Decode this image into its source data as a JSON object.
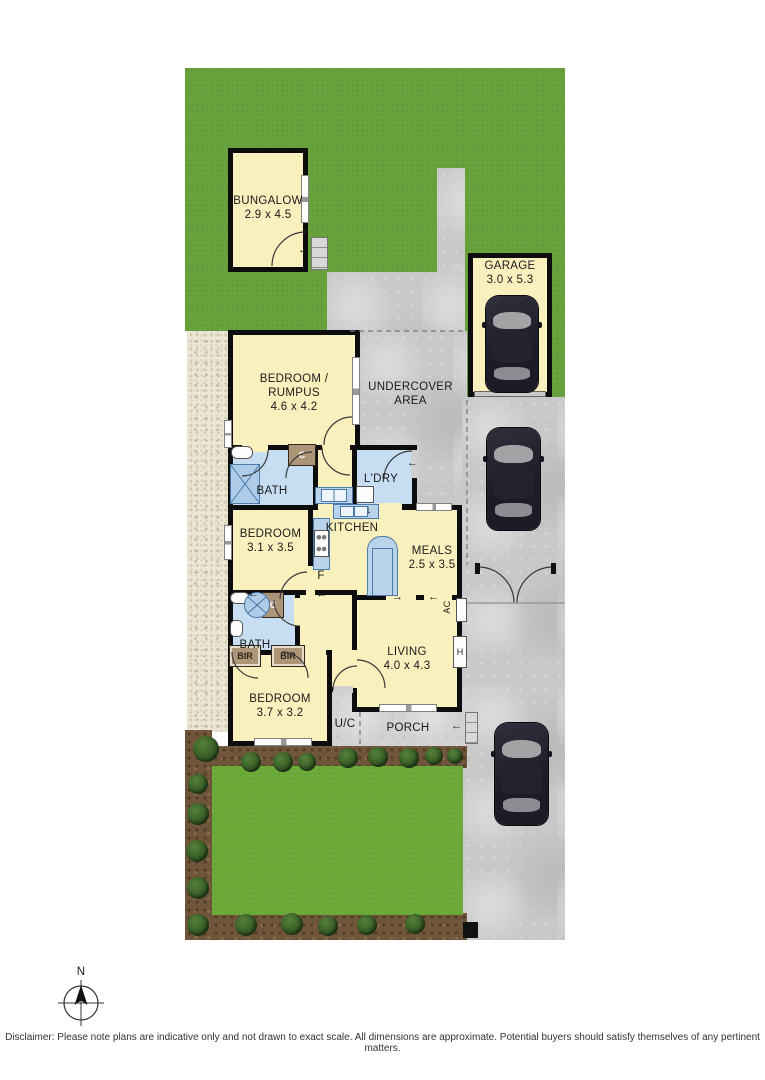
{
  "plan": {
    "outbuildings": {
      "bungalow": {
        "label": "BUNGALOW",
        "dims": "2.9 x 4.5"
      },
      "garage": {
        "label": "GARAGE",
        "dims": "3.0 x 5.3"
      }
    },
    "outdoor": {
      "undercover_line1": "UNDERCOVER",
      "undercover_line2": "AREA",
      "uc": "U/C",
      "porch": "PORCH"
    },
    "rooms": {
      "bedroom_rumpus": {
        "line1": "BEDROOM /",
        "line2": "RUMPUS",
        "dims": "4.6 x 4.2"
      },
      "bath1": {
        "label": "BATH"
      },
      "closet1": {
        "label": "C"
      },
      "laundry": {
        "label": "L'DRY"
      },
      "bedroom2": {
        "label": "BEDROOM",
        "dims": "3.1 x 3.5"
      },
      "kitchen": {
        "label": "KITCHEN"
      },
      "meals": {
        "label": "MEALS",
        "dims": "2.5 x 3.5"
      },
      "fridge": {
        "label": "F"
      },
      "bath2": {
        "label": "BATH"
      },
      "closet2": {
        "label": "C"
      },
      "bir1": {
        "label": "BIR"
      },
      "bir2": {
        "label": "BIR"
      },
      "living": {
        "label": "LIVING",
        "dims": "4.0 x 4.3"
      },
      "ac": {
        "label": "AC"
      },
      "heater": {
        "label": "H"
      },
      "bedroom3": {
        "label": "BEDROOM",
        "dims": "3.7 x 3.2"
      }
    }
  },
  "compass": {
    "label": "N"
  },
  "disclaimer": "Disclaimer: Please note plans are indicative only and not drawn to exact scale. All dimensions are approximate. Potential buyers should satisfy themselves of any pertinent matters.",
  "icons": {
    "arrow_left": "←",
    "arrow_right": "→",
    "arrow_down": "↓"
  },
  "colors": {
    "grass": "#68a23c",
    "lawn": "#6cab3a",
    "room_fill": "#faf0bd",
    "wet_fill": "#c7ddf1",
    "bench_fill": "#b9d3eb",
    "wall": "#0d0d0d",
    "concrete": "#c8c8c8",
    "porch": "#d2d2d2",
    "pebble": "#ece6d6",
    "garden_soil": "#6f5539",
    "bush": "#2f5220",
    "closet_tan": "#ad9678",
    "car_body": "#1c1c26",
    "window_frame": "#828282"
  }
}
